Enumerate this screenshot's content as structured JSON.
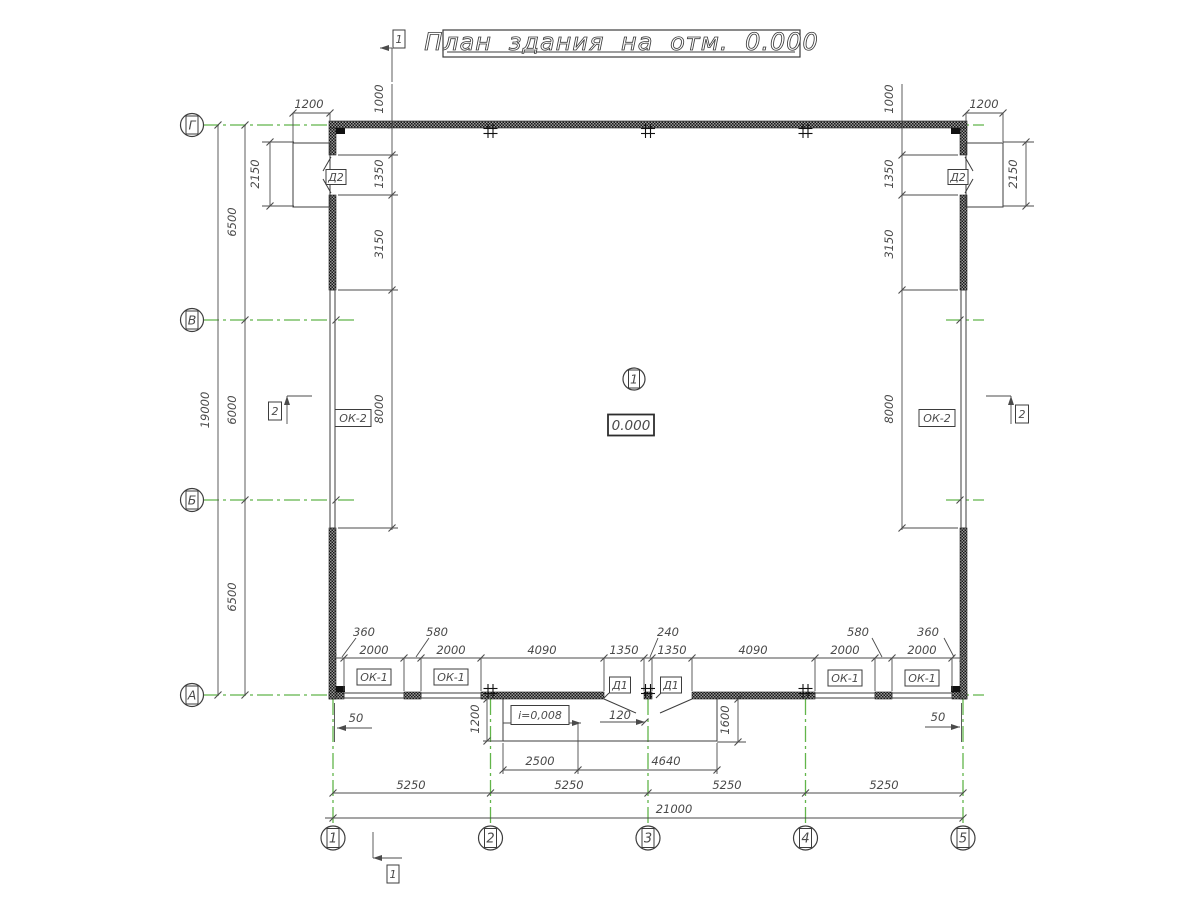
{
  "title": {
    "text": "План здания на отм. 0.000",
    "box": [
      443,
      30,
      357,
      27
    ],
    "underline": [
      447,
      52,
      795,
      52
    ],
    "font_size": 24
  },
  "colors": {
    "line": "#3d3d3d",
    "dim": "#4b4b4b",
    "green": "#62b54a",
    "text": "#4a4a4a",
    "bg": "#ffffff",
    "wall_dark": "#161616",
    "wall_mid": "#9a9a9a"
  },
  "axes": {
    "cols": {
      "bubble_cy": 838,
      "r": 12,
      "items": [
        {
          "label": "1",
          "x": 333
        },
        {
          "label": "2",
          "x": 490.5
        },
        {
          "label": "3",
          "x": 648
        },
        {
          "label": "4",
          "x": 805.5
        },
        {
          "label": "5",
          "x": 963
        }
      ]
    },
    "rows": {
      "bubble_cx": 192,
      "r": 11.5,
      "items": [
        {
          "label": "Г",
          "y": 125
        },
        {
          "label": "В",
          "y": 320
        },
        {
          "label": "Б",
          "y": 500
        },
        {
          "label": "А",
          "y": 695
        }
      ]
    }
  },
  "green_lines": {
    "h": [
      [
        125,
        203,
        357
      ],
      [
        125,
        946,
        984
      ],
      [
        320,
        203,
        357
      ],
      [
        320,
        946,
        984
      ],
      [
        500,
        203,
        357
      ],
      [
        500,
        946,
        984
      ],
      [
        695,
        203,
        357
      ],
      [
        695,
        946,
        984
      ]
    ],
    "v": [
      [
        333,
        699,
        826
      ],
      [
        490.5,
        699,
        826
      ],
      [
        648,
        699,
        826
      ],
      [
        805.5,
        699,
        826
      ],
      [
        963,
        699,
        826
      ]
    ]
  },
  "walls": [
    [
      329,
      121,
      638,
      7
    ],
    [
      329,
      692,
      15,
      7
    ],
    [
      404,
      692,
      17,
      7
    ],
    [
      481,
      692,
      123,
      7
    ],
    [
      644,
      692,
      8,
      7
    ],
    [
      692,
      692,
      123,
      7
    ],
    [
      875,
      692,
      17,
      7
    ],
    [
      952,
      692,
      15,
      7
    ],
    [
      329,
      128,
      7,
      27
    ],
    [
      329,
      195,
      7,
      95
    ],
    [
      329,
      528,
      7,
      171
    ],
    [
      960,
      128,
      7,
      27
    ],
    [
      960,
      195,
      7,
      95
    ],
    [
      960,
      528,
      7,
      171
    ]
  ],
  "corner_columns": [
    [
      336,
      128,
      9,
      6
    ],
    [
      951,
      128,
      9,
      6
    ],
    [
      336,
      686,
      9,
      6
    ],
    [
      951,
      686,
      9,
      6
    ]
  ],
  "windows": [
    [
      330,
      290,
      5,
      238
    ],
    [
      961,
      290,
      5,
      238
    ],
    [
      344,
      693,
      60,
      5
    ],
    [
      421,
      693,
      60,
      5
    ],
    [
      815,
      693,
      60,
      5
    ],
    [
      892,
      693,
      60,
      5
    ]
  ],
  "landings": [
    [
      293,
      143,
      37,
      64
    ],
    [
      966,
      143,
      37,
      64
    ]
  ],
  "ramp_lines": [
    [
      503,
      699,
      503,
      741
    ],
    [
      503,
      741,
      717,
      741
    ],
    [
      717,
      699,
      717,
      741
    ]
  ],
  "door_lines": [
    [
      331,
      157,
      323,
      171
    ],
    [
      331,
      193,
      323,
      179
    ],
    [
      965,
      157,
      973,
      171
    ],
    [
      965,
      193,
      973,
      179
    ],
    [
      604,
      699,
      636,
      713
    ],
    [
      692,
      699,
      660,
      713
    ],
    [
      609,
      693,
      604,
      698
    ],
    [
      661,
      693,
      656,
      698
    ]
  ],
  "dim_lines": [
    [
      218,
      125,
      218,
      695
    ],
    [
      245,
      125,
      245,
      695
    ],
    [
      270,
      142,
      270,
      206
    ],
    [
      262,
      142,
      294,
      142
    ],
    [
      262,
      206,
      294,
      206
    ],
    [
      293,
      113,
      330,
      113
    ],
    [
      293,
      113,
      293,
      142
    ],
    [
      330,
      113,
      330,
      122
    ],
    [
      392,
      84,
      392,
      530
    ],
    [
      338,
      155,
      398,
      155
    ],
    [
      338,
      195,
      398,
      195
    ],
    [
      338,
      290,
      398,
      290
    ],
    [
      338,
      528,
      398,
      528
    ],
    [
      966,
      113,
      1003,
      113
    ],
    [
      966,
      113,
      966,
      122
    ],
    [
      1003,
      113,
      1003,
      142
    ],
    [
      902,
      84,
      902,
      530
    ],
    [
      902,
      155,
      958,
      155
    ],
    [
      902,
      195,
      958,
      195
    ],
    [
      902,
      290,
      958,
      290
    ],
    [
      902,
      528,
      958,
      528
    ],
    [
      1026,
      142,
      1026,
      206
    ],
    [
      1003,
      142,
      1034,
      142
    ],
    [
      1003,
      206,
      1034,
      206
    ],
    [
      335,
      658,
      961,
      658
    ],
    [
      344,
      658,
      344,
      691
    ],
    [
      404,
      658,
      404,
      691
    ],
    [
      421,
      658,
      421,
      691
    ],
    [
      481,
      658,
      481,
      691
    ],
    [
      604,
      658,
      604,
      691
    ],
    [
      644,
      658,
      644,
      691
    ],
    [
      652,
      658,
      652,
      691
    ],
    [
      692,
      658,
      692,
      691
    ],
    [
      815,
      658,
      815,
      691
    ],
    [
      875,
      658,
      875,
      691
    ],
    [
      892,
      658,
      892,
      691
    ],
    [
      952,
      658,
      952,
      691
    ],
    [
      356,
      638,
      342,
      657
    ],
    [
      429,
      638,
      416,
      657
    ],
    [
      658,
      638,
      650,
      657
    ],
    [
      872,
      638,
      882,
      657
    ],
    [
      944,
      638,
      954,
      657
    ],
    [
      337,
      728,
      372,
      728
    ],
    [
      334.5,
      703,
      334.5,
      742
    ],
    [
      925,
      727,
      960,
      727
    ],
    [
      961.5,
      703,
      961.5,
      742
    ],
    [
      487,
      699,
      487,
      741
    ],
    [
      483,
      741,
      503,
      741
    ],
    [
      738,
      699,
      738,
      742
    ],
    [
      717,
      742,
      746,
      742
    ],
    [
      600,
      722,
      645,
      722
    ],
    [
      503,
      723,
      581,
      723
    ],
    [
      503,
      770,
      717,
      770
    ],
    [
      503,
      743,
      503,
      774
    ],
    [
      578,
      723,
      578,
      774
    ],
    [
      717,
      743,
      717,
      774
    ],
    [
      333,
      793,
      963,
      793
    ],
    [
      325,
      818,
      963,
      818
    ],
    [
      392,
      48,
      392,
      82
    ],
    [
      380,
      48,
      392,
      48
    ],
    [
      373,
      832,
      373,
      858
    ],
    [
      373,
      858,
      402,
      858
    ],
    [
      287,
      396,
      287,
      424
    ],
    [
      287,
      396,
      312,
      396
    ],
    [
      1011,
      396,
      1011,
      424
    ],
    [
      986,
      396,
      1011,
      396
    ]
  ],
  "ticks": [
    [
      218,
      125
    ],
    [
      218,
      695
    ],
    [
      245,
      125
    ],
    [
      245,
      320
    ],
    [
      245,
      500
    ],
    [
      245,
      695
    ],
    [
      270,
      142
    ],
    [
      270,
      206
    ],
    [
      1026,
      142
    ],
    [
      1026,
      206
    ],
    [
      293,
      113
    ],
    [
      330,
      113
    ],
    [
      966,
      113
    ],
    [
      1003,
      113
    ],
    [
      392,
      125
    ],
    [
      392,
      155
    ],
    [
      392,
      195
    ],
    [
      392,
      290
    ],
    [
      392,
      528
    ],
    [
      902,
      125
    ],
    [
      902,
      155
    ],
    [
      902,
      195
    ],
    [
      902,
      290
    ],
    [
      902,
      528
    ],
    [
      333,
      658
    ],
    [
      344,
      658
    ],
    [
      404,
      658
    ],
    [
      421,
      658
    ],
    [
      481,
      658
    ],
    [
      604,
      658
    ],
    [
      644,
      658
    ],
    [
      652,
      658
    ],
    [
      692,
      658
    ],
    [
      815,
      658
    ],
    [
      875,
      658
    ],
    [
      892,
      658
    ],
    [
      952,
      658
    ],
    [
      963,
      658
    ],
    [
      487,
      699
    ],
    [
      487,
      741
    ],
    [
      738,
      699
    ],
    [
      738,
      742
    ],
    [
      645,
      722
    ],
    [
      503,
      770
    ],
    [
      578,
      770
    ],
    [
      717,
      770
    ],
    [
      333,
      793
    ],
    [
      490.5,
      793
    ],
    [
      648,
      793
    ],
    [
      805.5,
      793
    ],
    [
      963,
      793
    ],
    [
      333,
      818
    ],
    [
      963,
      818
    ],
    [
      336,
      320
    ],
    [
      336,
      500
    ],
    [
      960,
      320
    ],
    [
      960,
      500
    ]
  ],
  "arrows": [
    [
      "l",
      337,
      728
    ],
    [
      "r",
      960,
      727
    ],
    [
      "r",
      645,
      722
    ],
    [
      "r",
      581,
      723
    ],
    [
      "l",
      380,
      48
    ],
    [
      "l",
      373,
      858
    ],
    [
      "u",
      287,
      396
    ],
    [
      "u",
      1011,
      396
    ]
  ],
  "crosses": [
    [
      490.5,
      131
    ],
    [
      648,
      131
    ],
    [
      805.5,
      131
    ],
    [
      490.5,
      691
    ],
    [
      648,
      691
    ],
    [
      805.5,
      691
    ]
  ],
  "texts_h": [
    [
      "1200",
      309,
      108
    ],
    [
      "1200",
      984,
      108
    ],
    [
      "2000",
      374,
      654
    ],
    [
      "2000",
      451,
      654
    ],
    [
      "4090",
      542,
      654
    ],
    [
      "1350",
      624,
      654
    ],
    [
      "1350",
      672,
      654
    ],
    [
      "4090",
      753,
      654
    ],
    [
      "2000",
      845,
      654
    ],
    [
      "2000",
      922,
      654
    ],
    [
      "360",
      364,
      636
    ],
    [
      "580",
      437,
      636
    ],
    [
      "240",
      668,
      636
    ],
    [
      "580",
      858,
      636
    ],
    [
      "360",
      928,
      636
    ],
    [
      "120",
      620,
      719
    ],
    [
      "50",
      356,
      722
    ],
    [
      "50",
      938,
      721
    ],
    [
      "2500",
      540,
      765
    ],
    [
      "4640",
      666,
      765
    ],
    [
      "5250",
      411,
      789
    ],
    [
      "5250",
      569,
      789
    ],
    [
      "5250",
      727,
      789
    ],
    [
      "5250",
      884,
      789
    ],
    [
      "21000",
      674,
      813
    ]
  ],
  "texts_v": [
    [
      "19000",
      209,
      410
    ],
    [
      "6500",
      236,
      222
    ],
    [
      "6000",
      236,
      410
    ],
    [
      "6500",
      236,
      597
    ],
    [
      "2150",
      259,
      174
    ],
    [
      "2150",
      1017,
      174
    ],
    [
      "1000",
      383,
      99
    ],
    [
      "1350",
      383,
      174
    ],
    [
      "3150",
      383,
      244
    ],
    [
      "8000",
      383,
      409
    ],
    [
      "1000",
      893,
      99
    ],
    [
      "1350",
      893,
      174
    ],
    [
      "3150",
      893,
      244
    ],
    [
      "8000",
      893,
      409
    ],
    [
      "1200",
      479,
      719
    ],
    [
      "1600",
      729,
      720
    ]
  ],
  "boxed_labels": [
    [
      "ОК-1",
      374,
      677,
      34,
      16
    ],
    [
      "ОК-1",
      451,
      677,
      34,
      16
    ],
    [
      "ОК-1",
      845,
      678,
      34,
      16
    ],
    [
      "ОК-1",
      922,
      678,
      34,
      16
    ],
    [
      "ОК-2",
      353,
      418,
      36,
      17
    ],
    [
      "ОК-2",
      937,
      418,
      36,
      17
    ],
    [
      "Д1",
      620,
      685,
      21,
      16
    ],
    [
      "Д1",
      671,
      685,
      21,
      16
    ],
    [
      "Д2",
      336,
      177,
      20,
      15
    ],
    [
      "Д2",
      958,
      177,
      20,
      15
    ],
    [
      "i=0,008",
      540,
      715,
      58,
      19
    ],
    [
      "1",
      399,
      39,
      12,
      18
    ],
    [
      "1",
      393,
      874,
      12,
      18
    ],
    [
      "2",
      275,
      411,
      13,
      18
    ],
    [
      "2",
      1022,
      414,
      13,
      18
    ]
  ],
  "elevation_box": {
    "text": "0.000",
    "cx": 631,
    "cy": 425,
    "w": 46,
    "h": 21
  },
  "room_tag": {
    "number": "1",
    "cx": 634,
    "cy": 379,
    "r": 11
  }
}
